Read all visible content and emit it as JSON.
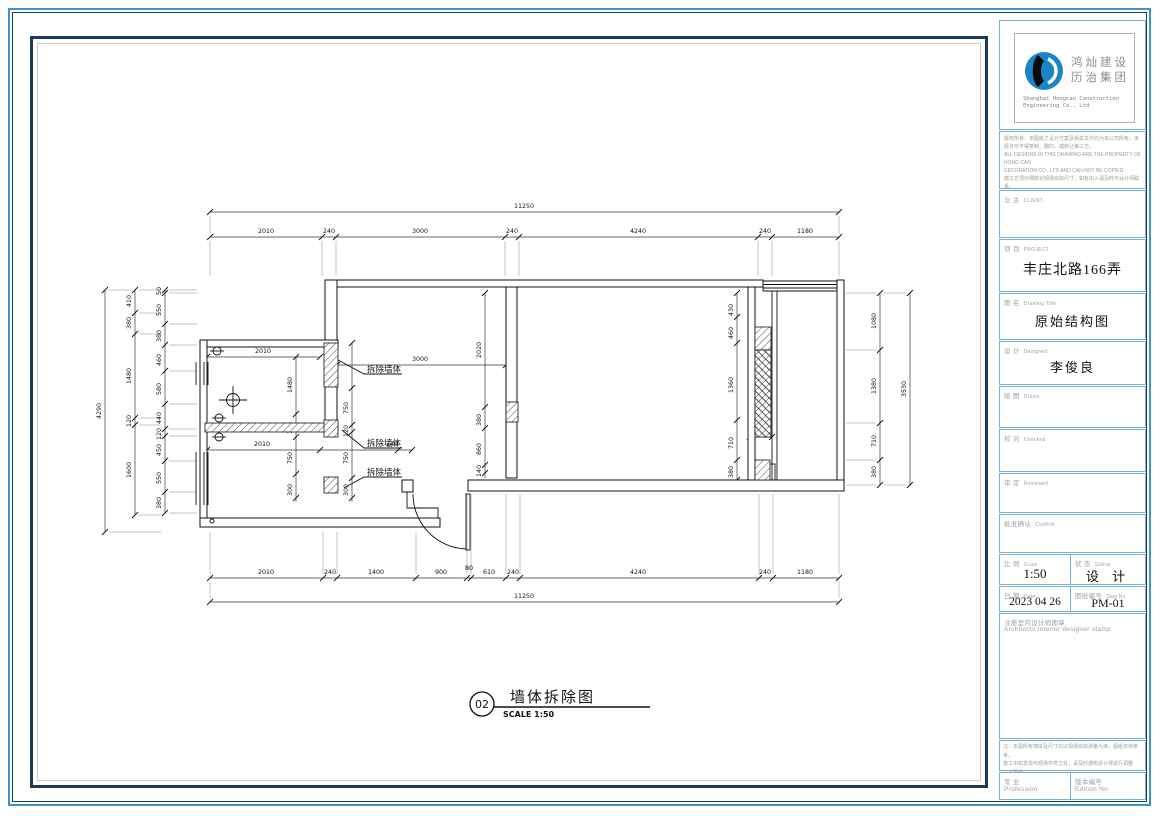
{
  "sheet": {
    "company": {
      "cn_line1": "鸿灿建设",
      "cn_line2": "历治集团",
      "en_line1": "Shanghai Hongcan Construction",
      "en_line2": "Engineering Co., Ltd"
    },
    "notes_lines": [
      "版权所有：本图纸之设计方案及相关文件均为本公司所有，未经许可不得复制、翻印，或转让第三方。",
      "ALL DESIGNS IN THIS DRAWING ARE THE PROPERTY OF HONG CAN",
      "DECORATION CO., LTD AND CAN NOT BE COPIED.",
      "施工方须仔细核对现场实际尺寸，如有出入请及时与设计师联系。",
      "IN ANY OTHER PROJECT, ALL DIMENSIONS MUST BE CHECKED AND",
      "VERIFIED ON SITE."
    ],
    "fields": {
      "client": {
        "cn": "业 主",
        "en": "CLIENT",
        "value": ""
      },
      "project": {
        "cn": "项 目",
        "en": "PROJECT",
        "value": "丰庄北路166弄"
      },
      "drawing_title": {
        "cn": "图 名",
        "en": "Drawing Title",
        "value": "原始结构图"
      },
      "designed": {
        "cn": "设 计",
        "en": "Designed",
        "value": "李俊良"
      },
      "drawn": {
        "cn": "绘 图",
        "en": "Drawn",
        "value": ""
      },
      "checked": {
        "cn": "校 对",
        "en": "Checked",
        "value": ""
      },
      "reviewed": {
        "cn": "审 定",
        "en": "Reviewed",
        "value": ""
      },
      "confirm": {
        "cn": "批准确认",
        "en": "Confirm",
        "value": ""
      },
      "scale": {
        "cn": "比 例",
        "en": "Scale",
        "value": "1:50"
      },
      "status": {
        "cn": "状 态",
        "en": "Status",
        "value": "设 计"
      },
      "date": {
        "cn": "日 期",
        "en": "Date",
        "value": "2023 04 26"
      },
      "dwg_no": {
        "cn": "图纸编号",
        "en": "Dwg No",
        "value": "PM-01"
      },
      "stamp": {
        "cn": "注册室内设计师图章",
        "en": "Architects Interior designer stamp"
      },
      "profession": {
        "cn": "专 业",
        "en": "Profession"
      },
      "edition": {
        "cn": "版本编号",
        "en": "Edition No"
      }
    },
    "disclaimer_lines": [
      "注：本图所有墙体及尺寸均以现场实际测量为准，图纸仅供参考。",
      "施工中如发现与现场不符之处，请及时通知设计师进行调整（本图纸",
      "版权归设计方所有），未经许可不得擅自修改、翻印，违者必究。"
    ]
  },
  "plan": {
    "bubble": {
      "number": "02",
      "title": "墙体拆除图",
      "scale": "SCALE 1:50"
    },
    "demolish_label": "拆除墙体",
    "dims": {
      "top_total": "11250",
      "top_chain": [
        "2010",
        "240",
        "3000",
        "240",
        "4240",
        "240",
        "1180"
      ],
      "bottom_chain": [
        "2010",
        "240",
        "1400",
        "900",
        "80",
        "610",
        "240",
        "4240",
        "240",
        "1180"
      ],
      "bottom_total": "11250",
      "left_total": "4290",
      "left_chain": [
        "410",
        "380",
        "1480",
        "120",
        "1600"
      ],
      "left_inner": [
        "50",
        "550",
        "380",
        "460",
        "580",
        "440",
        "120",
        "450",
        "550",
        "380"
      ],
      "right_chain": [
        "1080",
        "1380",
        "710",
        "380"
      ],
      "right_total": "3530",
      "wing_top": "2010",
      "mid_3000": "3000",
      "wing_mid_a": "2010",
      "wing_mid_b": "240",
      "leftv_a": [
        "1480",
        "120",
        "750",
        "300"
      ],
      "leftv_b": [
        "750",
        "120",
        "750",
        "300"
      ],
      "mid_chain": [
        "2020",
        "380",
        "860",
        "140"
      ],
      "room_chain": [
        "430",
        "460",
        "1360",
        "710",
        "380"
      ],
      "right_240": "240"
    }
  }
}
